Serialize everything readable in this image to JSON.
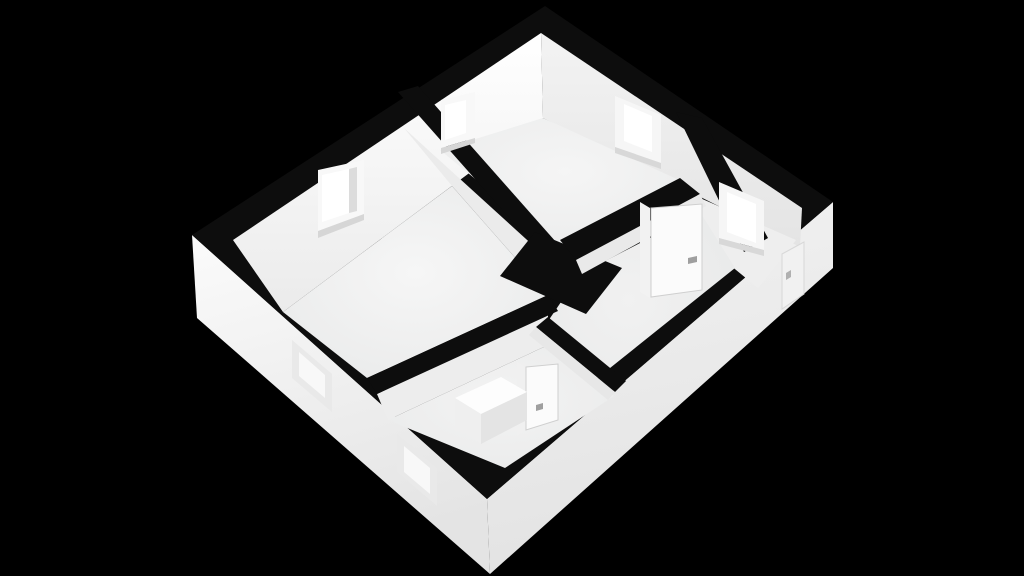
{
  "meta": {
    "description": "3D rendered floor plan of an apartment viewed isometrically from above on a black background",
    "canvas": {
      "width": 1024,
      "height": 576
    },
    "background_color": "#000000",
    "wall_cap_color": "#0d0d0d"
  },
  "render": {
    "windows_interior_count": 4,
    "windows_exterior_recessed_count": 2,
    "doors_interior_count": 2,
    "doors_entrance_count": 1,
    "rooms": [
      "living-room",
      "bedroom",
      "entrance-hall",
      "corridor",
      "bathroom"
    ]
  },
  "elements": [
    {
      "name": "exterior-wall-face-southwest",
      "type": "polygon",
      "fill": "url(#gExtSW)",
      "points": [
        [
          192,
          235
        ],
        [
          487,
          499
        ],
        [
          490,
          574
        ],
        [
          197,
          318
        ]
      ]
    },
    {
      "name": "exterior-wall-face-southeast",
      "type": "polygon",
      "fill": "url(#gExtSE)",
      "points": [
        [
          487,
          499
        ],
        [
          833,
          202
        ],
        [
          833,
          268
        ],
        [
          490,
          574
        ]
      ]
    },
    {
      "name": "wall-cap-roof-outline",
      "type": "polygon",
      "fill": "#0d0d0d",
      "points": [
        [
          545,
          6
        ],
        [
          833,
          202
        ],
        [
          487,
          499
        ],
        [
          192,
          235
        ]
      ]
    },
    {
      "name": "interior-wall-face-northwest",
      "type": "polygon",
      "fill": "url(#gNW)",
      "points": [
        [
          233,
          240
        ],
        [
          541,
          33
        ],
        [
          543,
          118
        ],
        [
          283,
          312
        ]
      ]
    },
    {
      "name": "interior-wall-face-northeast",
      "type": "polygon",
      "fill": "url(#gNE)",
      "points": [
        [
          541,
          33
        ],
        [
          802,
          208
        ],
        [
          800,
          247
        ],
        [
          543,
          118
        ]
      ]
    },
    {
      "name": "living-room-floor",
      "type": "polygon",
      "fill": "url(#gFloorA)",
      "points": [
        [
          283,
          312
        ],
        [
          452,
          186
        ],
        [
          548,
          295
        ],
        [
          367,
          378
        ]
      ]
    },
    {
      "name": "partition-wall-face-living-side",
      "type": "polygon",
      "fill": "#ebebeb",
      "points": [
        [
          404,
          128
        ],
        [
          537,
          249
        ],
        [
          548,
          295
        ],
        [
          452,
          186
        ]
      ]
    },
    {
      "name": "bedroom-floor",
      "type": "polygon",
      "fill": "url(#gFloorB)",
      "points": [
        [
          440,
          150
        ],
        [
          543,
          118
        ],
        [
          690,
          185
        ],
        [
          564,
          252
        ]
      ]
    },
    {
      "name": "entrance-hall-floor",
      "type": "polygon",
      "fill": "#eeeeee",
      "points": [
        [
          700,
          198
        ],
        [
          796,
          240
        ],
        [
          758,
          288
        ],
        [
          680,
          224
        ]
      ]
    },
    {
      "name": "corridor-floor",
      "type": "polygon",
      "fill": "url(#gFloorD)",
      "points": [
        [
          580,
          274
        ],
        [
          700,
          212
        ],
        [
          735,
          268
        ],
        [
          560,
          408
        ],
        [
          542,
          330
        ]
      ]
    },
    {
      "name": "bathroom-wall-face-north",
      "type": "polygon",
      "fill": "#ededed",
      "points": [
        [
          377,
          394
        ],
        [
          548,
          312
        ],
        [
          548,
          345
        ],
        [
          388,
          420
        ]
      ]
    },
    {
      "name": "bathroom-floor",
      "type": "polygon",
      "fill": "url(#gFloorBath)",
      "points": [
        [
          388,
          420
        ],
        [
          548,
          345
        ],
        [
          614,
          396
        ],
        [
          505,
          468
        ]
      ]
    },
    {
      "name": "wall-cap-partition-living-bedroom",
      "type": "polygon",
      "fill": "#0d0d0d",
      "points": [
        [
          398,
          92
        ],
        [
          537,
          249
        ],
        [
          556,
          242
        ],
        [
          418,
          86
        ]
      ]
    },
    {
      "name": "wall-cap-living-bathroom",
      "type": "polygon",
      "fill": "#0d0d0d",
      "points": [
        [
          367,
          378
        ],
        [
          548,
          295
        ],
        [
          558,
          311
        ],
        [
          377,
          394
        ]
      ]
    },
    {
      "name": "wall-junction-block",
      "type": "polygon",
      "fill": "#0d0d0d",
      "points": [
        [
          535,
          232
        ],
        [
          622,
          268
        ],
        [
          586,
          314
        ],
        [
          500,
          276
        ]
      ]
    },
    {
      "name": "wall-cap-bedroom-corridor",
      "type": "polygon",
      "fill": "#0d0d0d",
      "points": [
        [
          560,
          240
        ],
        [
          680,
          178
        ],
        [
          700,
          194
        ],
        [
          576,
          260
        ]
      ]
    },
    {
      "name": "wall-face-corridor-north",
      "type": "polygon",
      "fill": "#e9e9e9",
      "points": [
        [
          576,
          260
        ],
        [
          700,
          194
        ],
        [
          706,
          206
        ],
        [
          582,
          274
        ]
      ]
    },
    {
      "name": "wall-cap-hall-corridor",
      "type": "polygon",
      "fill": "#0d0d0d",
      "points": [
        [
          676,
          112
        ],
        [
          702,
          118
        ],
        [
          768,
          238
        ],
        [
          744,
          252
        ]
      ]
    },
    {
      "name": "wall-cap-bathroom-corridor",
      "type": "polygon",
      "fill": "#0d0d0d",
      "points": [
        [
          536,
          327
        ],
        [
          615,
          392
        ],
        [
          626,
          381
        ],
        [
          548,
          317
        ]
      ]
    },
    {
      "name": "wall-face-bathroom-east",
      "type": "polygon",
      "fill": "#e7e7e7",
      "points": [
        [
          536,
          327
        ],
        [
          615,
          392
        ],
        [
          608,
          400
        ],
        [
          529,
          335
        ]
      ]
    },
    {
      "name": "window-living-room-frame",
      "type": "polygon",
      "fill": "#f8f8f8",
      "points": [
        [
          318,
          170
        ],
        [
          364,
          160
        ],
        [
          364,
          214
        ],
        [
          318,
          231
        ]
      ]
    },
    {
      "name": "window-living-room-pane",
      "type": "polygon",
      "fill": "#ffffff",
      "points": [
        [
          322,
          175
        ],
        [
          349,
          169
        ],
        [
          349,
          213
        ],
        [
          322,
          222
        ]
      ]
    },
    {
      "name": "window-living-room-jamb-shadow",
      "type": "polygon",
      "fill": "#dcdcdc",
      "points": [
        [
          349,
          169
        ],
        [
          357,
          167
        ],
        [
          357,
          211
        ],
        [
          349,
          213
        ]
      ]
    },
    {
      "name": "window-living-room-sill-shadow",
      "type": "polygon",
      "fill": "#d6d6d6",
      "points": [
        [
          318,
          231
        ],
        [
          364,
          214
        ],
        [
          364,
          220
        ],
        [
          318,
          238
        ]
      ]
    },
    {
      "name": "window-bedroom-north-frame",
      "type": "polygon",
      "fill": "#f8f8f8",
      "points": [
        [
          441,
          100
        ],
        [
          475,
          92
        ],
        [
          475,
          138
        ],
        [
          441,
          148
        ]
      ]
    },
    {
      "name": "window-bedroom-north-pane",
      "type": "polygon",
      "fill": "#ffffff",
      "points": [
        [
          445,
          105
        ],
        [
          466,
          100
        ],
        [
          466,
          133
        ],
        [
          445,
          140
        ]
      ]
    },
    {
      "name": "window-bedroom-north-sill-shadow",
      "type": "polygon",
      "fill": "#d6d6d6",
      "points": [
        [
          441,
          148
        ],
        [
          475,
          138
        ],
        [
          475,
          143
        ],
        [
          441,
          154
        ]
      ]
    },
    {
      "name": "window-bedroom-east-frame",
      "type": "polygon",
      "fill": "#f6f6f6",
      "points": [
        [
          615,
          96
        ],
        [
          661,
          115
        ],
        [
          661,
          163
        ],
        [
          615,
          147
        ]
      ]
    },
    {
      "name": "window-bedroom-east-pane",
      "type": "polygon",
      "fill": "#ffffff",
      "points": [
        [
          624,
          104
        ],
        [
          652,
          116
        ],
        [
          652,
          152
        ],
        [
          624,
          141
        ]
      ]
    },
    {
      "name": "window-bedroom-east-sill-shadow",
      "type": "polygon",
      "fill": "#d8d8d8",
      "points": [
        [
          615,
          147
        ],
        [
          661,
          163
        ],
        [
          661,
          169
        ],
        [
          615,
          153
        ]
      ]
    },
    {
      "name": "window-hall-frame",
      "type": "polygon",
      "fill": "#f6f6f6",
      "points": [
        [
          719,
          182
        ],
        [
          764,
          201
        ],
        [
          764,
          250
        ],
        [
          719,
          238
        ]
      ]
    },
    {
      "name": "window-hall-pane",
      "type": "polygon",
      "fill": "#ffffff",
      "points": [
        [
          727,
          192
        ],
        [
          756,
          204
        ],
        [
          756,
          243
        ],
        [
          727,
          232
        ]
      ]
    },
    {
      "name": "window-hall-sill-shadow",
      "type": "polygon",
      "fill": "#d8d8d8",
      "points": [
        [
          719,
          238
        ],
        [
          764,
          250
        ],
        [
          764,
          256
        ],
        [
          719,
          244
        ]
      ]
    },
    {
      "name": "hall-door-jamb",
      "type": "polygon",
      "fill": "#f2f2f2",
      "points": [
        [
          640,
          202
        ],
        [
          650,
          208
        ],
        [
          650,
          298
        ],
        [
          640,
          292
        ]
      ]
    },
    {
      "name": "hall-door-panel",
      "type": "polygon",
      "fill": "#fbfbfb",
      "stroke": "#cfcfcf",
      "stroke_width": 1,
      "points": [
        [
          651,
          208
        ],
        [
          702,
          204
        ],
        [
          702,
          290
        ],
        [
          651,
          297
        ]
      ]
    },
    {
      "name": "hall-door-handle",
      "type": "polygon",
      "fill": "#9f9f9f",
      "points": [
        [
          688,
          258
        ],
        [
          697,
          256
        ],
        [
          697,
          262
        ],
        [
          688,
          264
        ]
      ]
    },
    {
      "name": "bathroom-door-jamb",
      "type": "polygon",
      "fill": "#f0f0f0",
      "points": [
        [
          517,
          362
        ],
        [
          525,
          367
        ],
        [
          525,
          430
        ],
        [
          517,
          436
        ]
      ]
    },
    {
      "name": "bathroom-door-panel",
      "type": "polygon",
      "fill": "#fbfbfb",
      "stroke": "#cfcfcf",
      "stroke_width": 1,
      "points": [
        [
          526,
          367
        ],
        [
          558,
          364
        ],
        [
          558,
          420
        ],
        [
          526,
          430
        ]
      ]
    },
    {
      "name": "bathroom-door-handle",
      "type": "polygon",
      "fill": "#9f9f9f",
      "points": [
        [
          536,
          405
        ],
        [
          543,
          403
        ],
        [
          543,
          409
        ],
        [
          536,
          411
        ]
      ]
    },
    {
      "name": "entrance-door-outline",
      "type": "polygon",
      "fill": "#f1f1f1",
      "stroke": "#d8d8d8",
      "stroke_width": 1,
      "points": [
        [
          782,
          254
        ],
        [
          804,
          242
        ],
        [
          804,
          294
        ],
        [
          782,
          309
        ]
      ]
    },
    {
      "name": "entrance-door-handle",
      "type": "polygon",
      "fill": "#b0b0b0",
      "points": [
        [
          786,
          273
        ],
        [
          791,
          270
        ],
        [
          791,
          277
        ],
        [
          786,
          280
        ]
      ]
    },
    {
      "name": "exterior-window-living-recess",
      "type": "polygon",
      "fill": "#e9e9e9",
      "points": [
        [
          292,
          340
        ],
        [
          332,
          374
        ],
        [
          332,
          412
        ],
        [
          292,
          378
        ]
      ]
    },
    {
      "name": "exterior-window-living-pane",
      "type": "polygon",
      "fill": "#f8f8f8",
      "points": [
        [
          299,
          352
        ],
        [
          325,
          375
        ],
        [
          325,
          398
        ],
        [
          299,
          376
        ]
      ]
    },
    {
      "name": "exterior-window-bathroom-recess",
      "type": "polygon",
      "fill": "#e9e9e9",
      "points": [
        [
          397,
          434
        ],
        [
          437,
          468
        ],
        [
          437,
          506
        ],
        [
          397,
          472
        ]
      ]
    },
    {
      "name": "exterior-window-bathroom-pane",
      "type": "polygon",
      "fill": "#f8f8f8",
      "points": [
        [
          404,
          446
        ],
        [
          430,
          468
        ],
        [
          430,
          494
        ],
        [
          404,
          472
        ]
      ]
    },
    {
      "name": "bathtub-top-face",
      "type": "polygon",
      "fill": "#fdfdfd",
      "points": [
        [
          455,
          398
        ],
        [
          501,
          377
        ],
        [
          527,
          392
        ],
        [
          481,
          414
        ]
      ]
    },
    {
      "name": "bathtub-front-left-face",
      "type": "polygon",
      "fill": "#efefef",
      "points": [
        [
          455,
          398
        ],
        [
          481,
          414
        ],
        [
          481,
          444
        ],
        [
          455,
          426
        ]
      ]
    },
    {
      "name": "bathtub-front-right-face",
      "type": "polygon",
      "fill": "#e4e4e4",
      "points": [
        [
          481,
          414
        ],
        [
          527,
          392
        ],
        [
          527,
          420
        ],
        [
          481,
          444
        ]
      ]
    }
  ]
}
